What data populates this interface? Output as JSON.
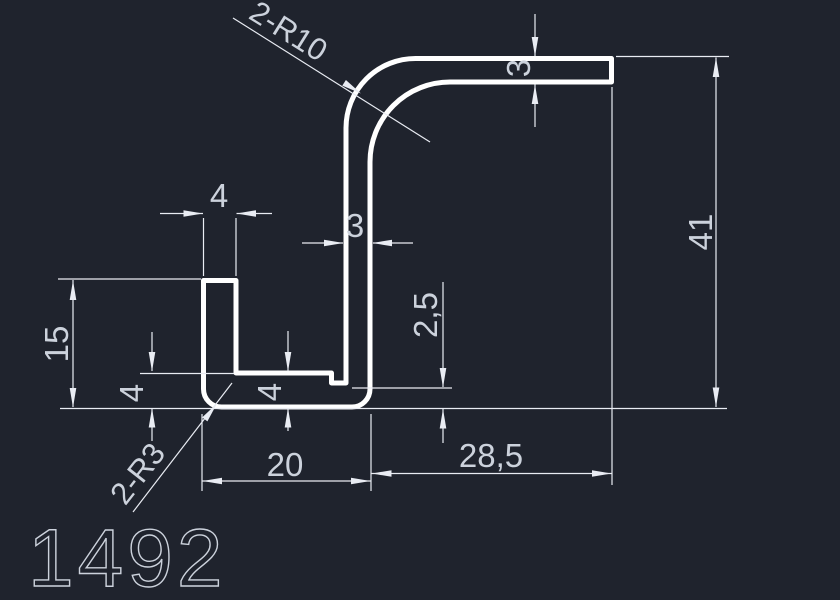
{
  "drawing": {
    "part_number": "1492",
    "dimensions": {
      "top_flange_thickness": "3",
      "web_thickness": "3",
      "overall_height": "41",
      "right_flange_extent": "28,5",
      "base_width": "20",
      "leg_height": "15",
      "leg_width": "4",
      "base_thickness_left": "4",
      "base_thickness_mid": "4",
      "step_height": "2,5",
      "bend_radius_label": "2-R10",
      "corner_radius_label": "2-R3"
    },
    "colors": {
      "background": "#1f232d",
      "profile_line": "#ffffff",
      "dimension_line": "#e9ecf3",
      "dimension_text": "#ccd2dc"
    }
  }
}
